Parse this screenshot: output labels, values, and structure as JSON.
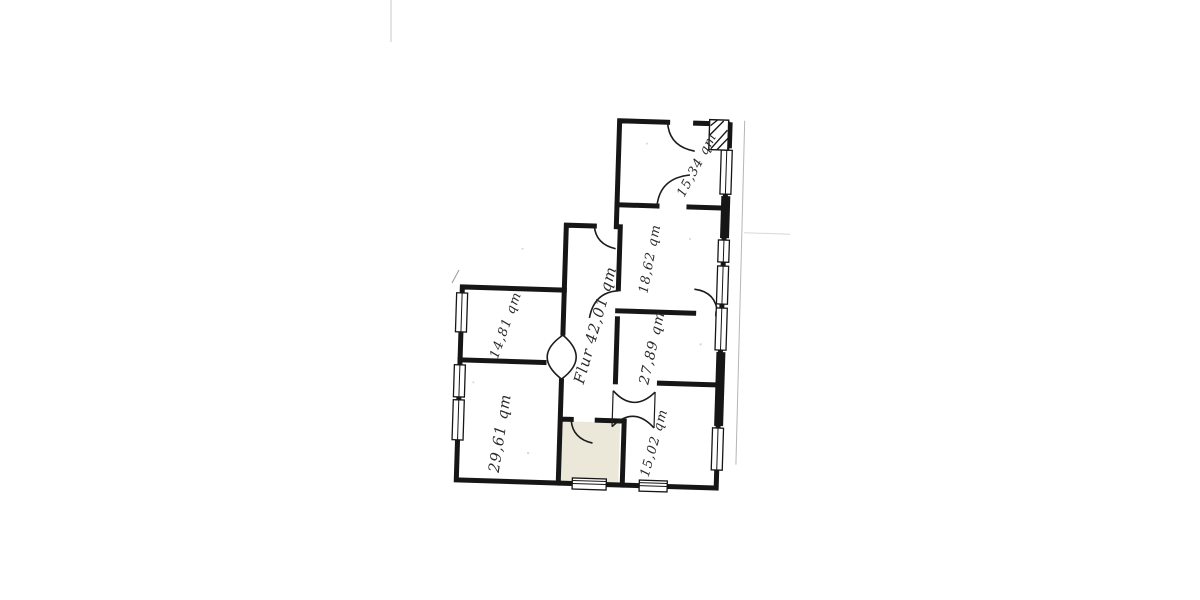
{
  "plan": {
    "colors": {
      "wall": "#161616",
      "paper": "#ffffff",
      "highlight_room_fill": "#ebe8da"
    },
    "labels": {
      "flur": "Flur 42,01 qm",
      "room_top_left": "14,81 qm",
      "room_bottom_left": "29,61 qm",
      "room_right_middle": "27,89 qm",
      "room_right_upper": "18,62 qm",
      "room_top_right": "15,34 qm",
      "room_bottom_right": "15,02 qm"
    }
  }
}
